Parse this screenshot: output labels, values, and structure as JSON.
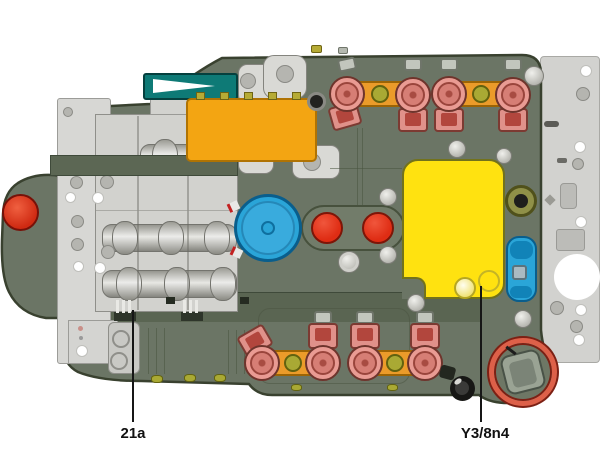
{
  "callouts": {
    "left": {
      "label": "21a"
    },
    "right": {
      "label": "Y3/8n4"
    }
  },
  "colors": {
    "background": "#ffffff",
    "body_olive": "#6b7565",
    "body_outline": "#39412f",
    "side_plate_gray": "#d2d2cf",
    "valve_plate_gray": "#d2d2ce",
    "selector_teal": "#0e7a76",
    "connector_block_orange": "#f3a512",
    "solenoid_pink": "#e99b93",
    "solenoid_link_bar_orange": "#eb9b2a",
    "control_unit_yellow": "#ffe210",
    "sensor_blue": "#2aa5d8",
    "valve_red": "#e63a20",
    "round_plug_coral": "#dd6049",
    "callout_text": "#161616"
  }
}
